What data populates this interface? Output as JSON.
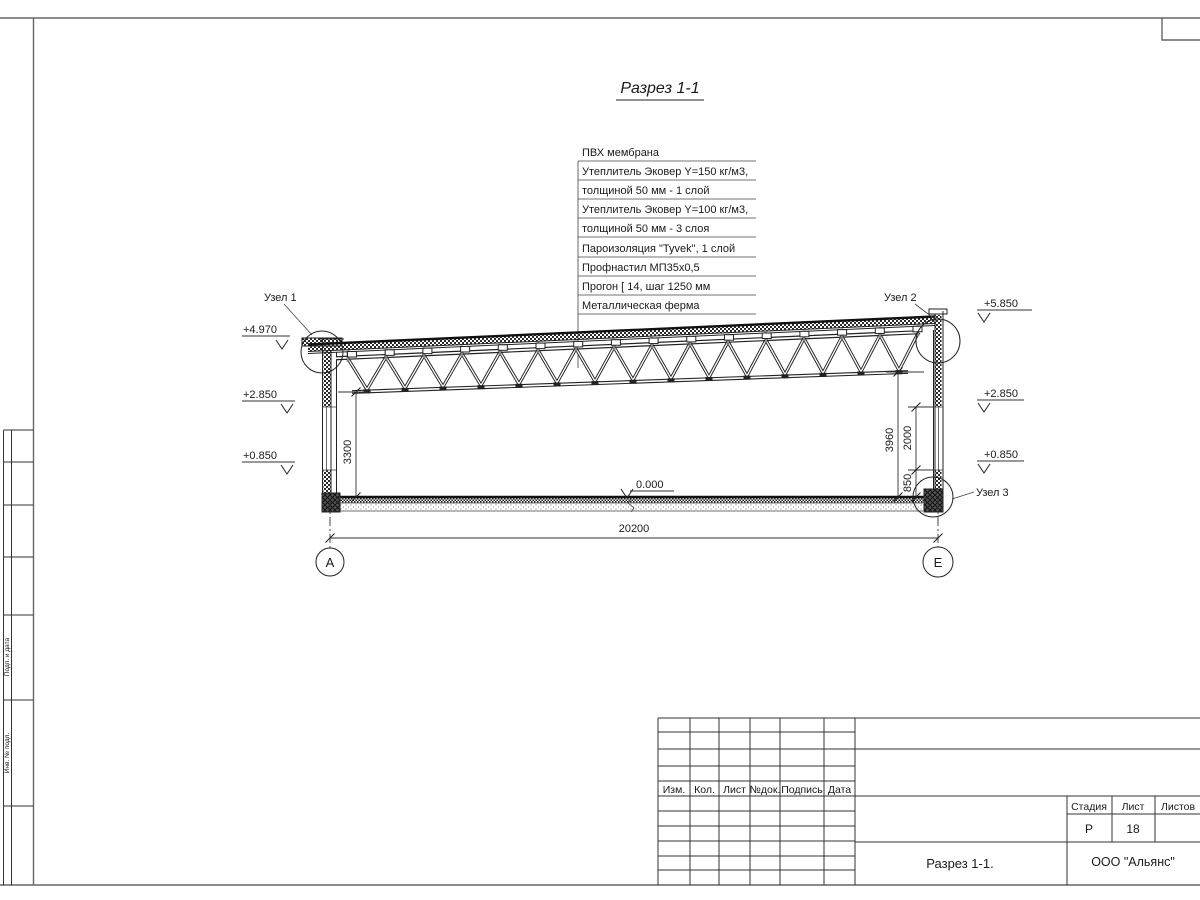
{
  "title": "Разрез 1-1",
  "spec": {
    "items": [
      "ПВХ мембрана",
      "Утеплитель Эковер Y=150 кг/м3,",
      "толщиной 50 мм - 1 слой",
      "Утеплитель Эковер Y=100 кг/м3,",
      "толщиной 50 мм - 3 слоя",
      "Пароизоляция \"Tyvek\", 1 слой",
      "Профнастил МП35х0,5",
      "Прогон [ 14, шаг 1250 мм",
      "Металлическая ферма"
    ]
  },
  "nodes": {
    "n1": "Узел 1",
    "n2": "Узел 2",
    "n3": "Узел 3"
  },
  "levels": {
    "l_top": "+4.970",
    "l_mid": "+2.850",
    "l_low": "+0.850",
    "r_top": "+5.850",
    "r_mid": "+2.850",
    "r_low": "+0.850",
    "zero": "0.000"
  },
  "dims": {
    "total": "20200",
    "left_h": "3300",
    "right_h": "3960",
    "win": "2000",
    "sill": "850"
  },
  "axes": {
    "a": "А",
    "e": "Е"
  },
  "titleblock": {
    "rev": "Изм.",
    "qty": "Кол.",
    "sheet_col": "Лист",
    "doc": "№док.",
    "sign": "Подпись",
    "date": "Дата",
    "stage_lbl": "Стадия",
    "sheet_lbl": "Лист",
    "sheets_lbl": "Листов",
    "stage": "Р",
    "sheet_num": "18",
    "doc_name": "Разрез 1-1.",
    "company": "ООО \"Альянс\""
  },
  "side": {
    "s1": "Подп. и дата",
    "s2": "Инв. № подл."
  }
}
